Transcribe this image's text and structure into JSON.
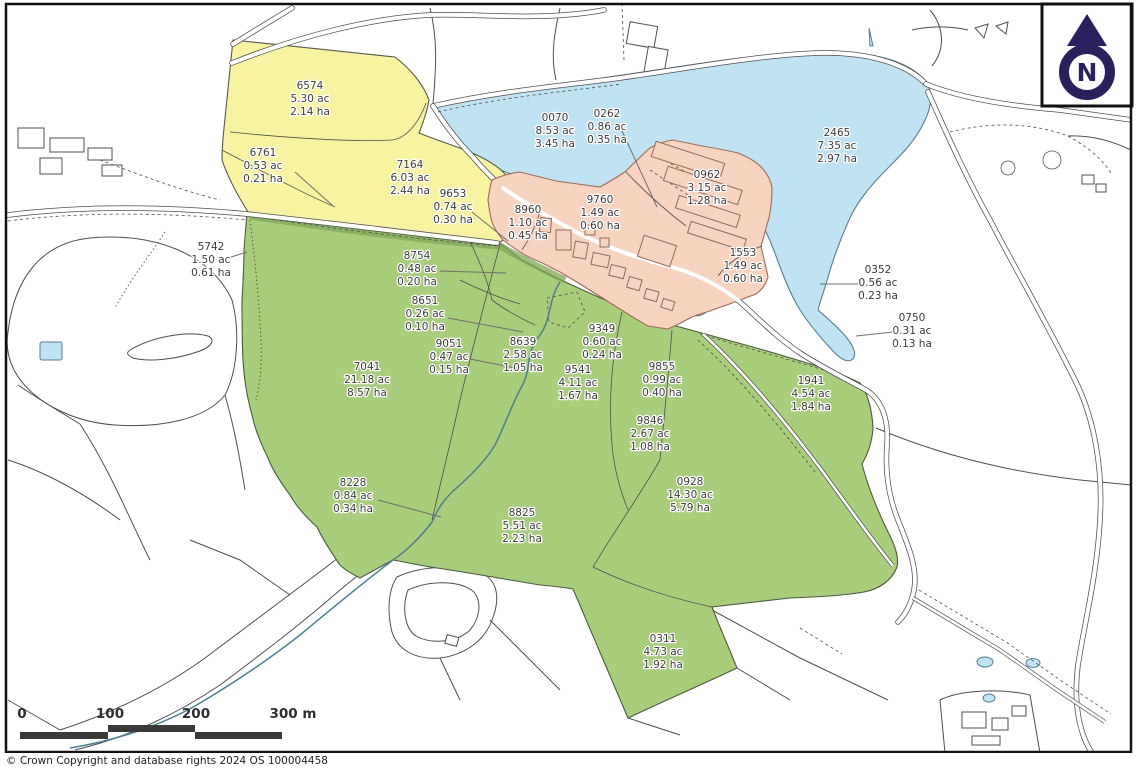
{
  "map": {
    "copyright": "© Crown Copyright and database rights 2024 OS 100004458",
    "north_label": "N",
    "scale_bar": {
      "labels": [
        "0",
        "100",
        "200",
        "300 m"
      ],
      "label_x": [
        22,
        110,
        196,
        293
      ]
    },
    "colors": {
      "yellow": "#f7f3a0",
      "green": "#a8cd7b",
      "blue": "#bfe3f2",
      "pink": "#f8d3c0",
      "purple": "#2c1f5e",
      "line": "#4f4f4f",
      "labeltext": "#3c3c3c"
    },
    "parcels": [
      {
        "id": "6574",
        "acres": "5.30 ac",
        "hectares": "2.14 ha",
        "x": 310,
        "y": 89,
        "zone": "yellow"
      },
      {
        "id": "6761",
        "acres": "0.53 ac",
        "hectares": "0.21 ha",
        "x": 263,
        "y": 156,
        "zone": "yellow"
      },
      {
        "id": "7164",
        "acres": "6.03 ac",
        "hectares": "2.44 ha",
        "x": 410,
        "y": 168,
        "zone": "yellow"
      },
      {
        "id": "9653",
        "acres": "0.74 ac",
        "hectares": "0.30 ha",
        "x": 453,
        "y": 197,
        "zone": "yellow"
      },
      {
        "id": "0070",
        "acres": "8.53 ac",
        "hectares": "3.45 ha",
        "x": 555,
        "y": 121,
        "zone": "water"
      },
      {
        "id": "0262",
        "acres": "0.86 ac",
        "hectares": "0.35 ha",
        "x": 607,
        "y": 117,
        "zone": "water"
      },
      {
        "id": "2465",
        "acres": "7.35 ac",
        "hectares": "2.97 ha",
        "x": 837,
        "y": 136,
        "zone": "water"
      },
      {
        "id": "0962",
        "acres": "3.15 ac",
        "hectares": "1.28 ha",
        "x": 707,
        "y": 178,
        "zone": "pink"
      },
      {
        "id": "9760",
        "acres": "1.49 ac",
        "hectares": "0.60 ha",
        "x": 600,
        "y": 203,
        "zone": "pink"
      },
      {
        "id": "8960",
        "acres": "1.10 ac",
        "hectares": "0.45 ha",
        "x": 528,
        "y": 213,
        "zone": "pink"
      },
      {
        "id": "5742",
        "acres": "1.50 ac",
        "hectares": "0.61 ha",
        "x": 211,
        "y": 250,
        "zone": "green"
      },
      {
        "id": "8754",
        "acres": "0.48 ac",
        "hectares": "0.20 ha",
        "x": 417,
        "y": 259,
        "zone": "green"
      },
      {
        "id": "1553",
        "acres": "1.49 ac",
        "hectares": "0.60 ha",
        "x": 743,
        "y": 256,
        "zone": "pink"
      },
      {
        "id": "0352",
        "acres": "0.56 ac",
        "hectares": "0.23 ha",
        "x": 878,
        "y": 273,
        "zone": "water"
      },
      {
        "id": "8651",
        "acres": "0.26 ac",
        "hectares": "0.10 ha",
        "x": 425,
        "y": 304,
        "zone": "green"
      },
      {
        "id": "0750",
        "acres": "0.31 ac",
        "hectares": "0.13 ha",
        "x": 912,
        "y": 321,
        "zone": "water"
      },
      {
        "id": "9349",
        "acres": "0.60 ac",
        "hectares": "0.24 ha",
        "x": 602,
        "y": 332,
        "zone": "green"
      },
      {
        "id": "9051",
        "acres": "0.47 ac",
        "hectares": "0.15 ha",
        "x": 449,
        "y": 347,
        "zone": "green"
      },
      {
        "id": "8639",
        "acres": "2.58 ac",
        "hectares": "1.05 ha",
        "x": 523,
        "y": 345,
        "zone": "green"
      },
      {
        "id": "9541",
        "acres": "4.11 ac",
        "hectares": "1.67 ha",
        "x": 578,
        "y": 373,
        "zone": "green"
      },
      {
        "id": "9855",
        "acres": "0.99 ac",
        "hectares": "0.40 ha",
        "x": 662,
        "y": 370,
        "zone": "green"
      },
      {
        "id": "7041",
        "acres": "21.18 ac",
        "hectares": "8.57 ha",
        "x": 367,
        "y": 370,
        "zone": "green"
      },
      {
        "id": "1941",
        "acres": "4.54 ac",
        "hectares": "1.84 ha",
        "x": 811,
        "y": 384,
        "zone": "green"
      },
      {
        "id": "9846",
        "acres": "2.67 ac",
        "hectares": "1.08 ha",
        "x": 650,
        "y": 424,
        "zone": "green"
      },
      {
        "id": "8228",
        "acres": "0.84 ac",
        "hectares": "0.34 ha",
        "x": 353,
        "y": 486,
        "zone": "green"
      },
      {
        "id": "0928",
        "acres": "14.30 ac",
        "hectares": "5.79 ha",
        "x": 690,
        "y": 485,
        "zone": "green"
      },
      {
        "id": "8825",
        "acres": "5.51 ac",
        "hectares": "2.23 ha",
        "x": 522,
        "y": 516,
        "zone": "green"
      },
      {
        "id": "0311",
        "acres": "4.73 ac",
        "hectares": "1.92 ha",
        "x": 663,
        "y": 642,
        "zone": "green"
      }
    ],
    "leaders": [
      [
        295,
        172,
        333,
        206
      ],
      [
        472,
        212,
        508,
        241
      ],
      [
        622,
        131,
        657,
        207
      ],
      [
        228,
        258,
        247,
        252
      ],
      [
        440,
        271,
        506,
        273
      ],
      [
        448,
        318,
        523,
        332
      ],
      [
        470,
        359,
        520,
        369
      ],
      [
        858,
        284,
        820,
        284
      ],
      [
        893,
        332,
        856,
        336
      ],
      [
        378,
        500,
        441,
        517
      ]
    ]
  }
}
